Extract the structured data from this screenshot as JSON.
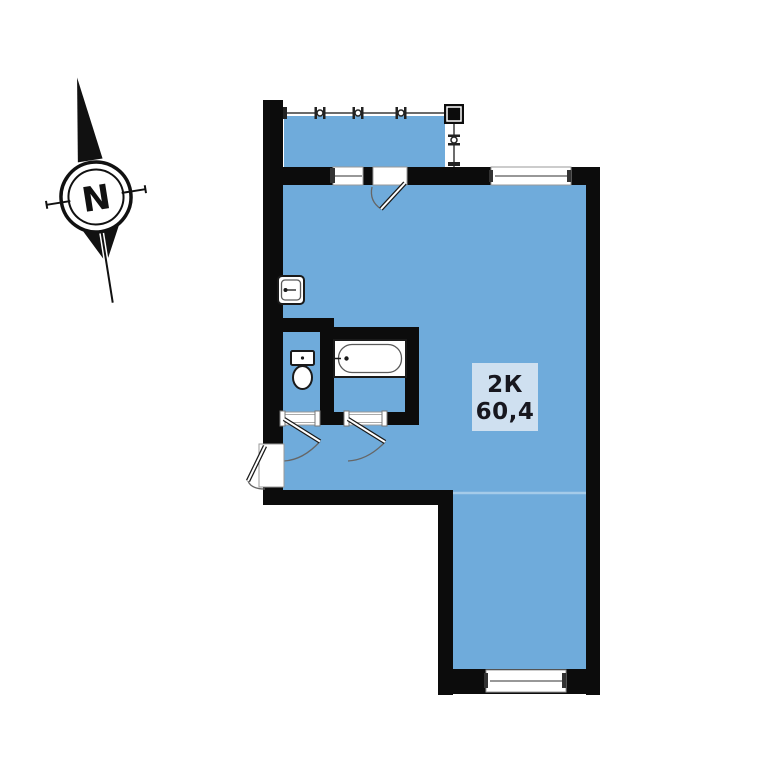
{
  "title": "Apartment floor plan",
  "compass": {
    "north_label": "N"
  },
  "unit": {
    "type_label": "2К",
    "area_label": "60,4"
  },
  "colors": {
    "bg": "#ffffff",
    "fill": "#6fabdb",
    "wall": "#0c0c0c",
    "label-bg": "#cfe0f0",
    "label-text": "#17171f"
  }
}
